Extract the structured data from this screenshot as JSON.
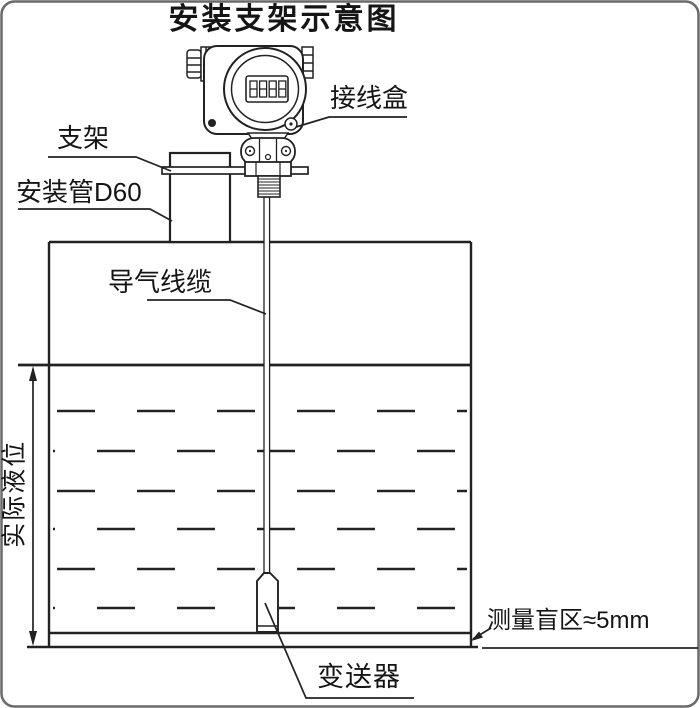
{
  "title": "安装支架示意图",
  "device": {
    "display_value": "8888"
  },
  "labels": {
    "junction_box": "接线盒",
    "bracket": "支架",
    "mounting_pipe": "安装管D60",
    "air_cable": "导气线缆",
    "actual_level": "实际液位",
    "blind_zone": "测量盲区≈5mm",
    "transmitter": "变送器"
  },
  "colors": {
    "line": "#222222",
    "background": "#ffffff",
    "text": "#111111"
  }
}
